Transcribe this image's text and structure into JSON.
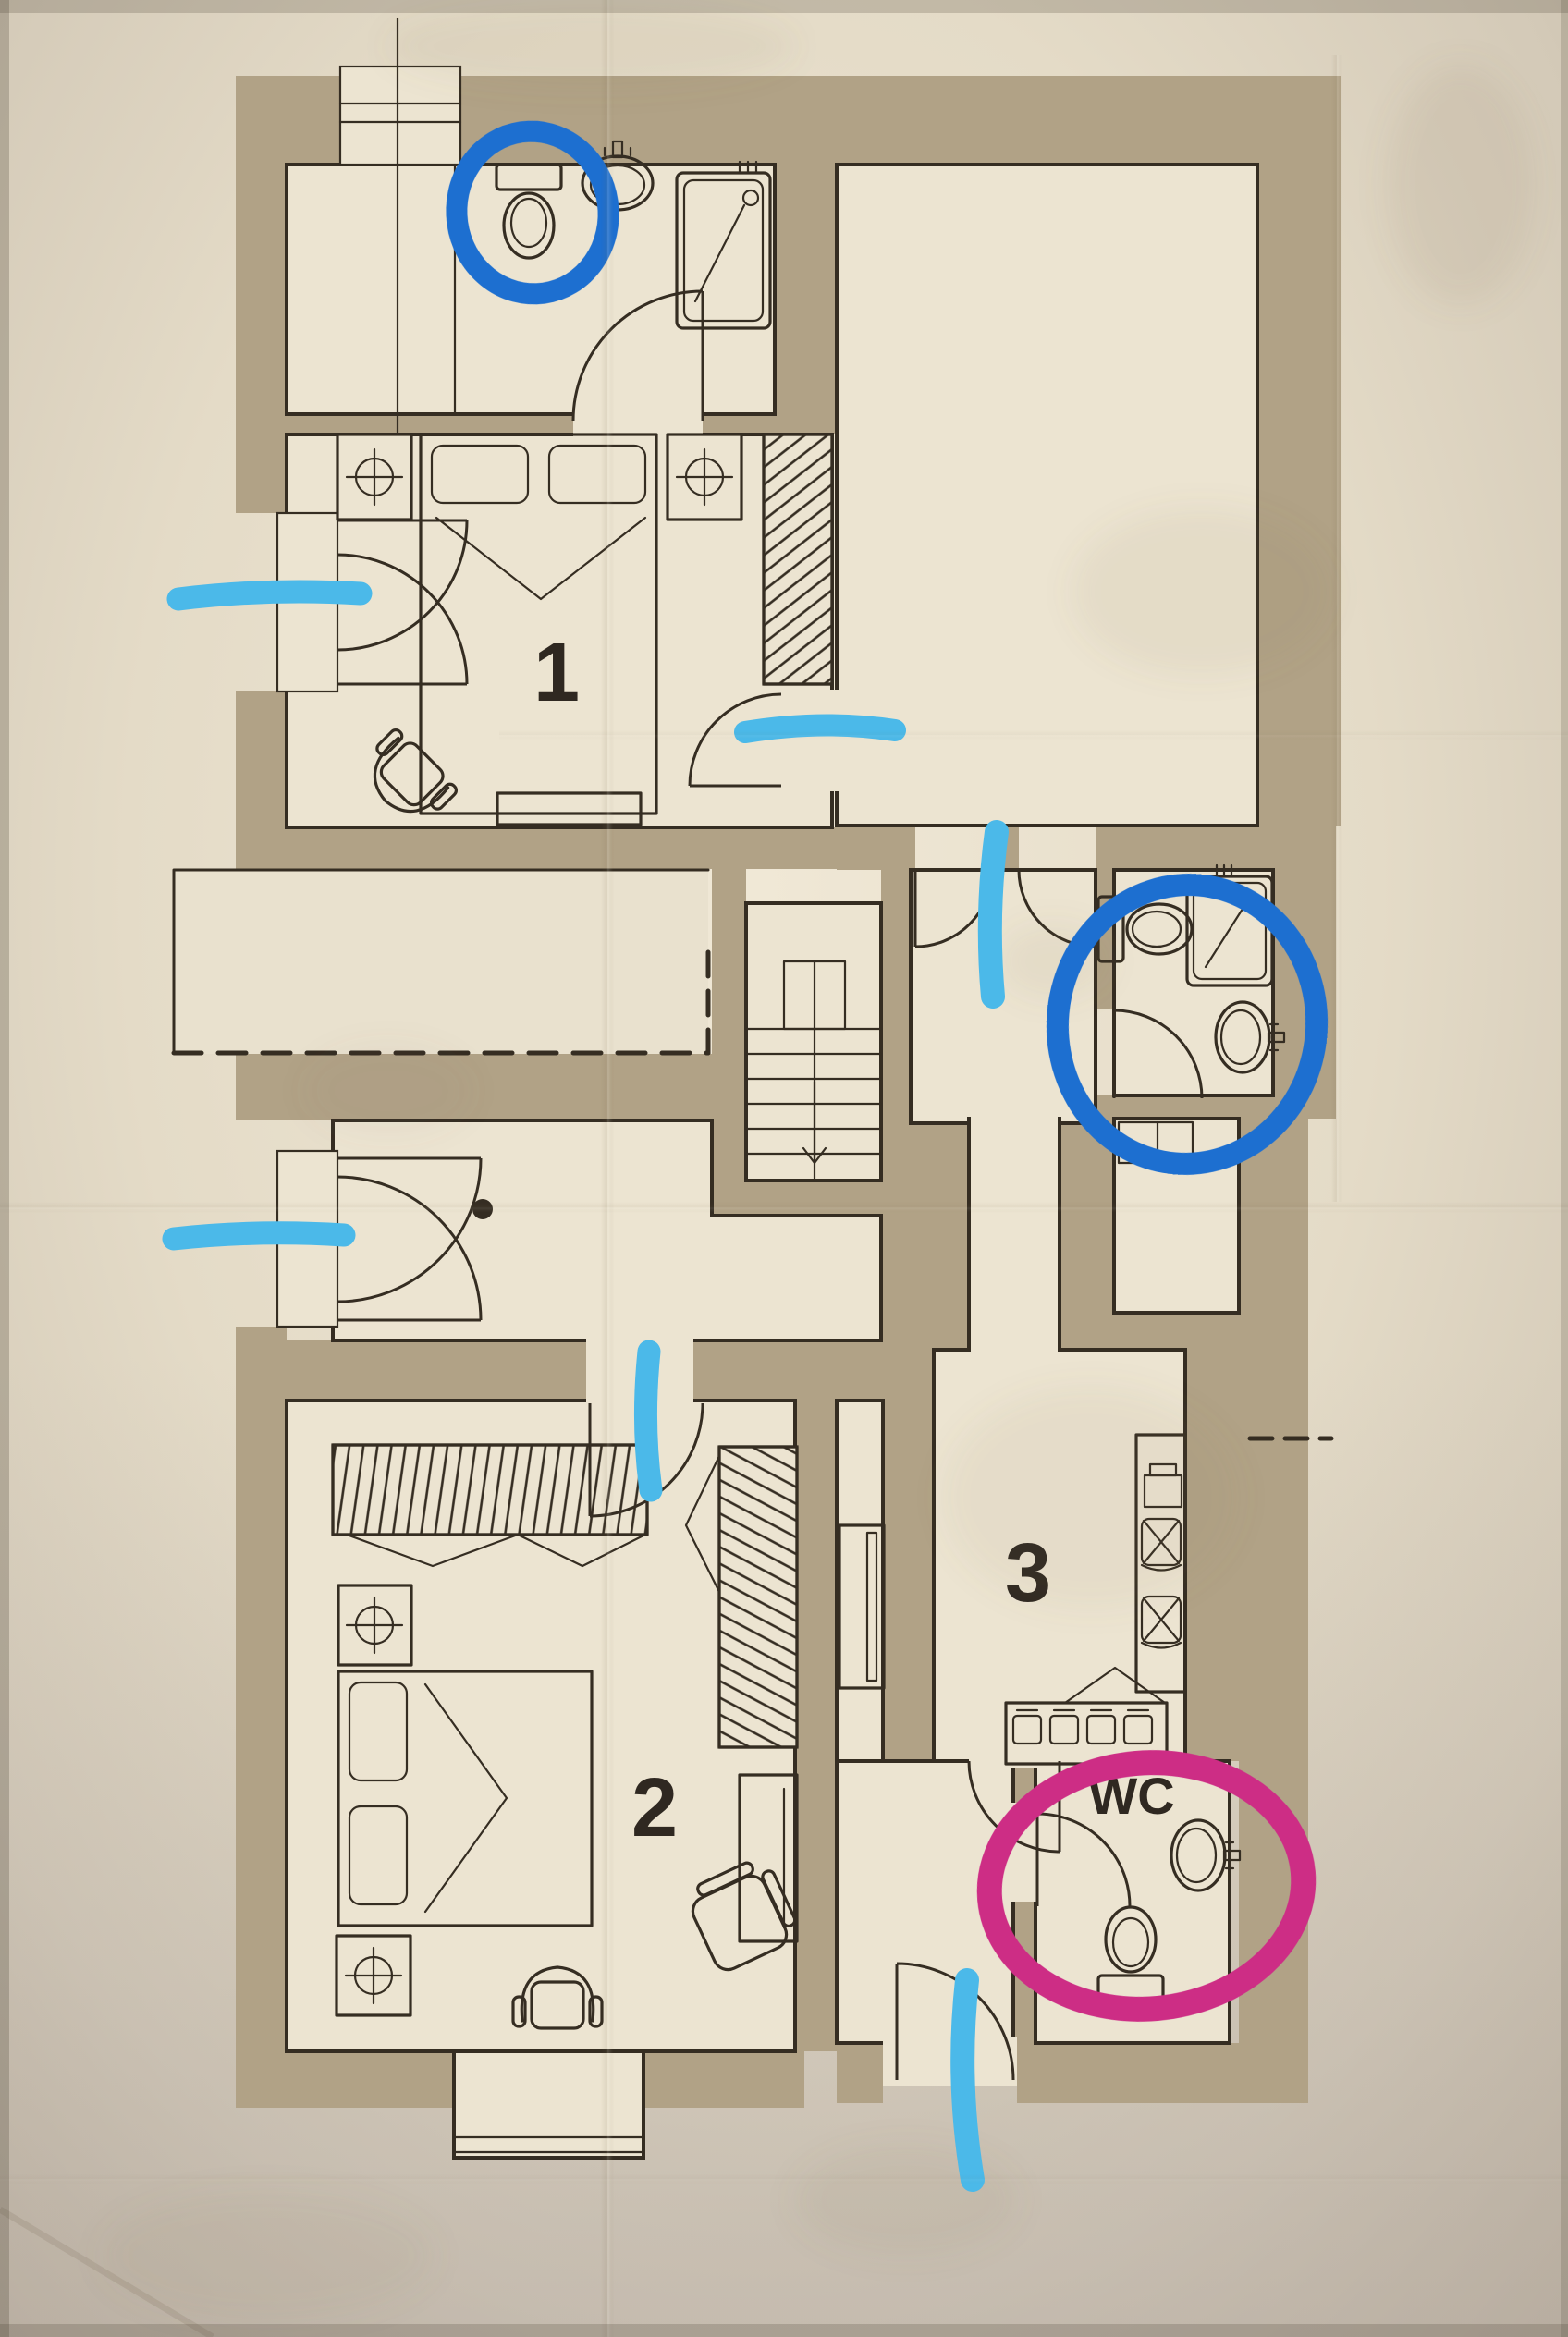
{
  "photo": {
    "kind": "photograph of a paper floor plan with hand-drawn marker annotations",
    "paper_color": "#e3dac6",
    "margin_color": "#c9bfae",
    "wall_color": "#b1a286",
    "ink_color": "#352d22",
    "room_color": "#ece4d1"
  },
  "plan": {
    "room_labels": [
      {
        "id": "room-1",
        "label": "1"
      },
      {
        "id": "room-2",
        "label": "2"
      },
      {
        "id": "room-3",
        "label": "3"
      },
      {
        "id": "wc",
        "label": "WC"
      }
    ],
    "fixture_icons": [
      "toilet-icon",
      "sink-icon",
      "shower-icon",
      "bed-icon",
      "pillow-icon",
      "ceiling-light-icon",
      "wardrobe-hatched-icon",
      "armchair-icon",
      "lounge-chair-icon",
      "stairs-icon",
      "stairs-arrow-icon",
      "stove-counter-icon",
      "fridge-icon",
      "dining-chair-icon",
      "desk-icon",
      "cabinet-icon",
      "bay-window-icon",
      "terrace-dashed-boundary",
      "door-swing-icon"
    ]
  },
  "annotations": {
    "colors": {
      "blue": "#1d6fd0",
      "cyan": "#4bb9e9",
      "magenta": "#cd2d85"
    },
    "items": [
      {
        "shape": "circle",
        "color": "blue",
        "marks": "toilet-in-bathroom-1"
      },
      {
        "shape": "circle",
        "color": "blue",
        "marks": "bathroom-2"
      },
      {
        "shape": "circle",
        "color": "magenta",
        "marks": "wc"
      },
      {
        "shape": "stroke",
        "color": "cyan",
        "marks": "bedroom-1-balcony-door"
      },
      {
        "shape": "stroke",
        "color": "cyan",
        "marks": "bedroom-1-door"
      },
      {
        "shape": "stroke",
        "color": "cyan",
        "marks": "vestibule-double-door"
      },
      {
        "shape": "stroke",
        "color": "cyan",
        "marks": "hall-balcony-door"
      },
      {
        "shape": "stroke",
        "color": "cyan",
        "marks": "bedroom-2-door"
      },
      {
        "shape": "stroke",
        "color": "cyan",
        "marks": "entry-door"
      }
    ]
  }
}
